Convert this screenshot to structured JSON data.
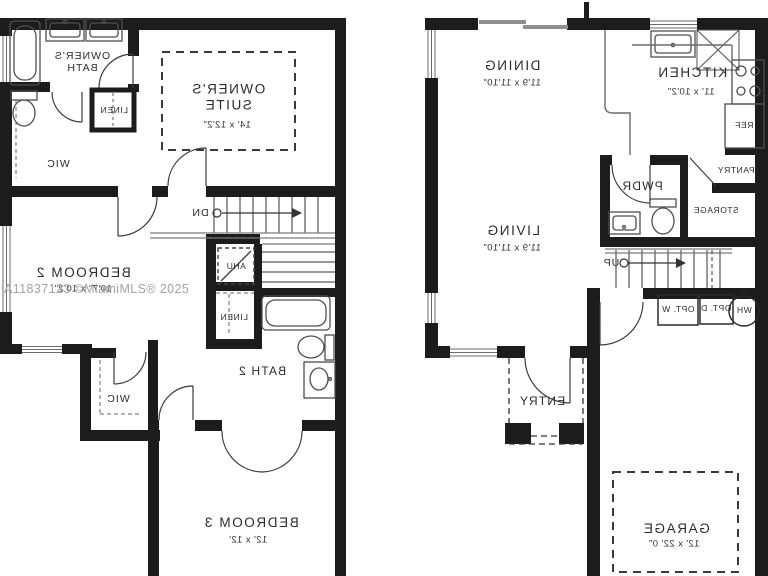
{
  "watermark": "A11837123 ©MiamiMLS® 2025",
  "upper_floor": {
    "owners_bath": "OWNER'S BATH",
    "owners_suite": "OWNER'S SUITE",
    "owners_suite_dims": "14' x 12'2\"",
    "linen_upper": "LINEN",
    "wic_owner": "WIC",
    "stairs_dn": "DN",
    "ahu": "AHU",
    "bedroom2": "BEDROOM 2",
    "bedroom2_dims": "10'7\" x 10'2\"",
    "linen_hall": "LINEN",
    "bath2": "BATH 2",
    "wic_bedroom2": "WIC",
    "bedroom3": "BEDROOM 3",
    "bedroom3_dims": "12' x 12'"
  },
  "main_floor": {
    "dining": "DINING",
    "dining_dims": "11'9 x 11'10\"",
    "kitchen": "KITCHEN",
    "kitchen_dims": "11' x 10'2\"",
    "ref": "REF",
    "pantry": "PANTRY",
    "pwdr": "PWDR",
    "storage": "STORAGE",
    "living": "LIVING",
    "living_dims": "11'9 x 11'10\"",
    "stairs_up": "UP",
    "opt_washer": "OPT. W",
    "opt_dryer": "OPT. D",
    "water_heater": "WH",
    "entry": "ENTRY",
    "garage": "GARAGE",
    "garage_dims": "12' x 22' 0\""
  }
}
